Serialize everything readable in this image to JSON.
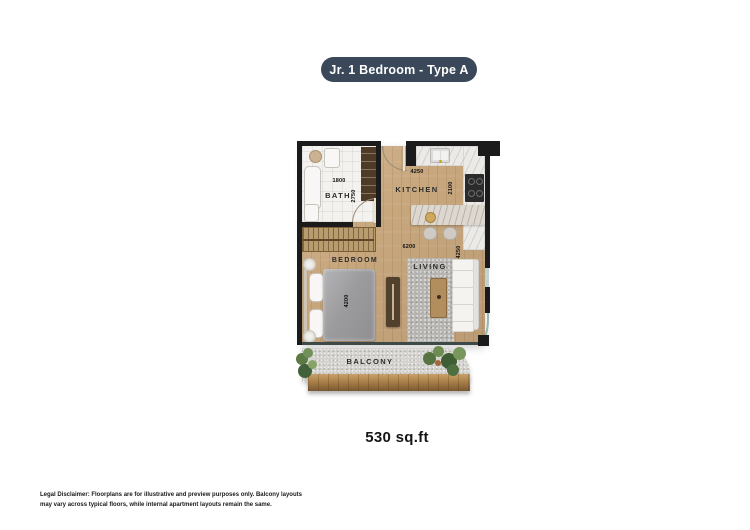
{
  "page": {
    "banner_label": "Jr. 1 Bedroom - Type A",
    "area_label": "530 sq.ft",
    "disclaimer": "Legal Disclaimer: Floorplans are for illustrative and preview purposes only. Balcony layouts may vary across typical floors, while internal apartment layouts remain the same."
  },
  "rooms": {
    "bath": {
      "label": "BATH",
      "width_mm": "1800",
      "depth_mm": "2750"
    },
    "kitchen": {
      "label": "KITCHEN",
      "width_mm": "4250",
      "depth_mm": "2100"
    },
    "bedroom": {
      "label": "BEDROOM",
      "bed_length_mm": "4200"
    },
    "living": {
      "label": "LIVING"
    },
    "balcony": {
      "label": "BALCONY"
    }
  },
  "overall_dims": {
    "width_mm": "6200",
    "depth_mm": "4250"
  },
  "colors": {
    "banner_bg": "#3b4859",
    "banner_text": "#ffffff",
    "wall": "#1b1b1b",
    "wood_floor": "#c8a77d",
    "marble": "#eceae6",
    "glass_balustrade": "#98b7b1",
    "balcony_floor": "#d3d2ce",
    "deck_wood": "#aa8049"
  }
}
